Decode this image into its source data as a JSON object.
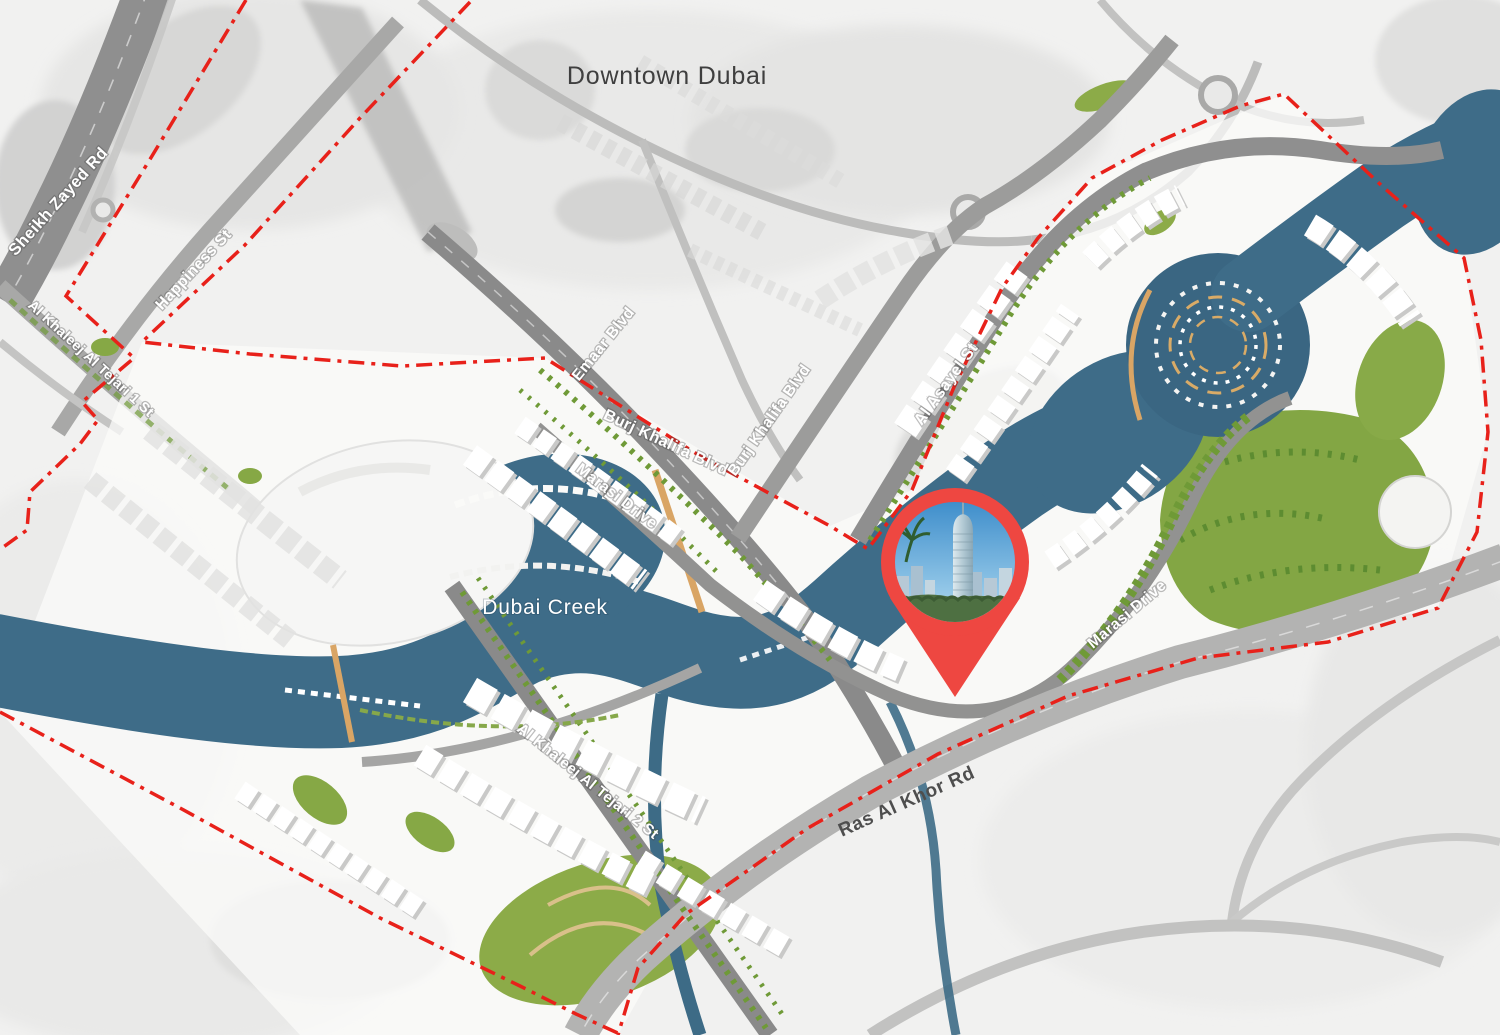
{
  "map": {
    "type": "masterplan-map",
    "region": "Dubai Creek Harbour development plan",
    "area_labels": {
      "downtown_dubai": "Downtown Dubai",
      "dubai_creek": "Dubai Creek"
    },
    "road_labels": {
      "sheikh_zayed_rd": "Sheikh Zayed Rd",
      "happiness_st": "Happiness St",
      "al_khaleej_al_tejari_1_st": "Al Khaleej Al Tejari 1 St",
      "emaar_blvd": "Emaar Blvd",
      "burj_khalifa_blvd_west": "Burj Khalifa Blvd",
      "burj_khalifa_blvd_east": "Burj Khalifa Blvd",
      "marasi_drive_center": "Marasi Drive",
      "marasi_drive_east": "Marasi Drive",
      "al_asayel_st": "Al Asayel St",
      "al_khaleej_al_tejari_2_st": "Al Khaleej Al Tejari 2 St",
      "ras_al_khor_rd": "Ras Al Khor Rd"
    },
    "marker": {
      "name": "location-pin",
      "content": "circular photo of twisting skyscraper with palm tree and city skyline"
    },
    "colors": {
      "water": "#3e6c88",
      "boundary_red": "#e8211a",
      "pin_red": "#ee4741",
      "greenery": "#83a644",
      "road_gray": "#8f8f8f",
      "context_bg": "#f1f1f0",
      "label_white": "#ffffff",
      "label_dark": "#3d3d3d"
    }
  }
}
